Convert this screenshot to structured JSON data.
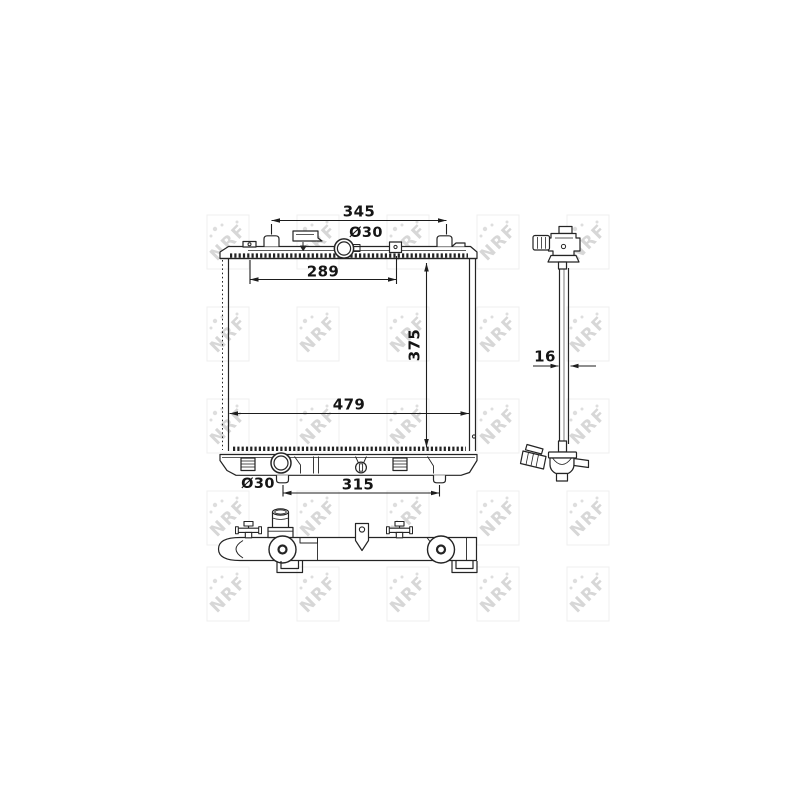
{
  "watermark": {
    "label": "NRF",
    "color": "#d7d7d7",
    "dot_color": "#dedede",
    "box_color": "#efefef",
    "cols": [
      228,
      318,
      408,
      498,
      588
    ],
    "rows": [
      242,
      334,
      426,
      518,
      594
    ]
  },
  "drawing": {
    "line_color": "#242424",
    "dimensions": {
      "top_mount_span": "345",
      "filler_diameter": "Ø30",
      "upper_bracket_span": "289",
      "core_height": "375",
      "overall_width": "479",
      "outlet_diameter": "Ø30",
      "lower_mount_span": "315",
      "core_depth": "16"
    }
  }
}
